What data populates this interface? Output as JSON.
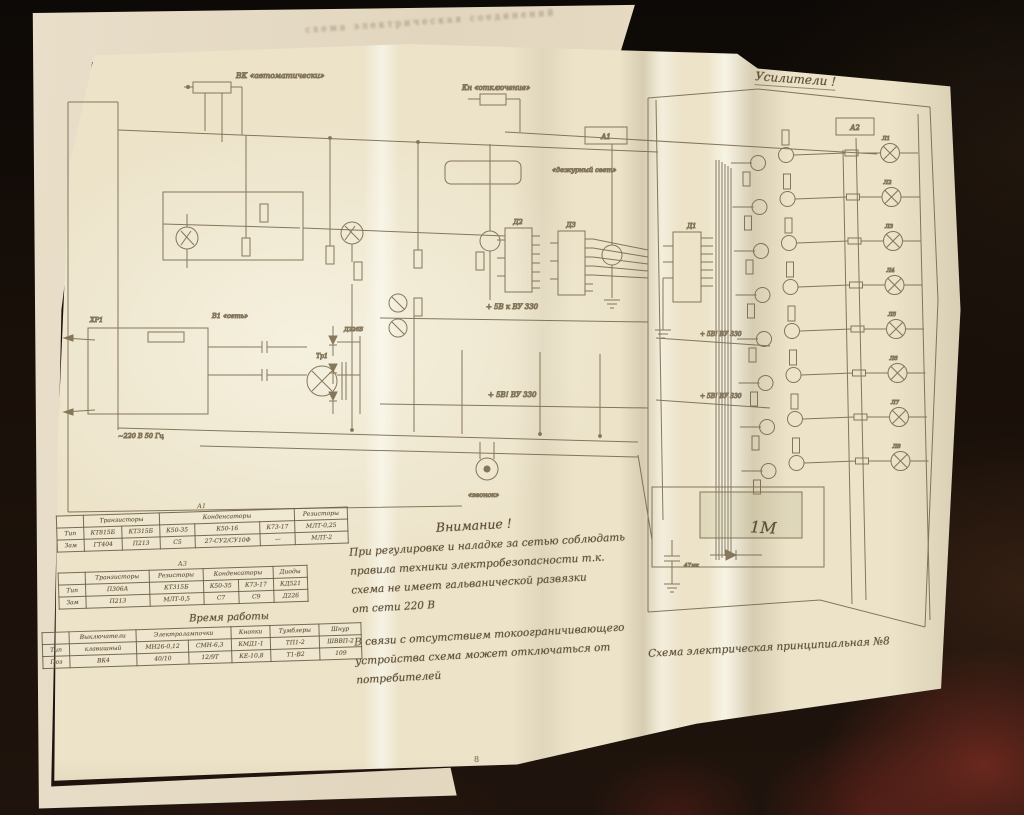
{
  "page": {
    "number": "8",
    "back_header": "схема  электрическая  соединений"
  },
  "handwritten": {
    "amplifiers_title": "Усилители !",
    "one_m": "1М",
    "note_heading": "Внимание !",
    "note_lines": [
      "При регулировке и наладке за сетью соблюдать",
      "правила техники электробезопасности т.к.",
      "схема не имеет гальванической развязки",
      "от сети 220 В"
    ],
    "note_lines2": [
      "В связи с отсутствием токоограничивающего",
      "устройства  схема  может  отключаться  от",
      "потребителей"
    ],
    "caption": "Схема электрическая принципиальная  №8"
  },
  "tables": [
    {
      "title": "А1",
      "rows": [
        [
          [
            "",
            1
          ],
          [
            "Транзисторы",
            2
          ],
          [
            "Конденсаторы",
            3
          ],
          [
            "Резисторы",
            1
          ]
        ],
        [
          "Тип",
          "КТ815Б",
          "КТ315Б",
          "К50-35",
          "К50-16",
          "К73-17",
          "МЛТ-0,25"
        ],
        [
          "Зам",
          "ГТ404",
          "П213",
          "С5",
          "27-СУ2/СУ10Ф",
          "—",
          "МЛТ-2"
        ]
      ]
    },
    {
      "title": "А3",
      "rows": [
        [
          [
            "",
            1
          ],
          [
            "Транзисторы",
            1
          ],
          [
            "Резисторы",
            1
          ],
          [
            "Конденсаторы",
            2
          ],
          [
            "Диоды",
            1
          ]
        ],
        [
          "Тип",
          "П306А",
          "КТ315Б",
          "К50-35",
          "К73-17",
          "КД521"
        ],
        [
          "Зам",
          "П213",
          "МЛТ-0,5",
          "С7",
          "С9",
          "Д226"
        ]
      ]
    },
    {
      "title": "Время работы",
      "rows": [
        [
          [
            "",
            1
          ],
          [
            "Выключатели",
            1
          ],
          [
            "Электролампочки",
            2
          ],
          [
            "Кнопки",
            1
          ],
          [
            "Тумблеры",
            1
          ],
          [
            "Шнур",
            1
          ]
        ],
        [
          "Тип",
          "клавишный",
          "МН26-0,12",
          "СМН-6,3",
          "КМД1-1",
          "ТП1-2",
          "ШВВП-2"
        ],
        [
          "Поз",
          "ВК4",
          "40/10",
          "12/9Т",
          "КЕ-10,8",
          "Т1-В2",
          "109"
        ]
      ]
    }
  ],
  "schematic": {
    "labels": {
      "switch_auto": "ВК «автоматически»",
      "switch_off": "Кн «отключение»",
      "block_a1": "А1",
      "duty_light": "«дежурный свет»",
      "switch_net": "В1 «сеть»",
      "plug": "ХР1",
      "mains": "~220 В 50 Гц",
      "ic1": "Д1",
      "ic2": "Д2",
      "ic3": "Д3",
      "block_a2": "А2",
      "transformer": "Тр1",
      "diode": "Д226Б",
      "buzzer": "«звонок»",
      "cap47": "47мк",
      "rails": [
        "+ 5В к ВУ 330",
        "+ 5В! ВУ 330",
        "+ 5В! ВУ 330",
        "+ 5В! ВУ 330"
      ],
      "lamps": [
        "Л1",
        "Л2",
        "Л3",
        "Л4",
        "Л5",
        "Л6",
        "Л7",
        "Л8"
      ]
    }
  }
}
